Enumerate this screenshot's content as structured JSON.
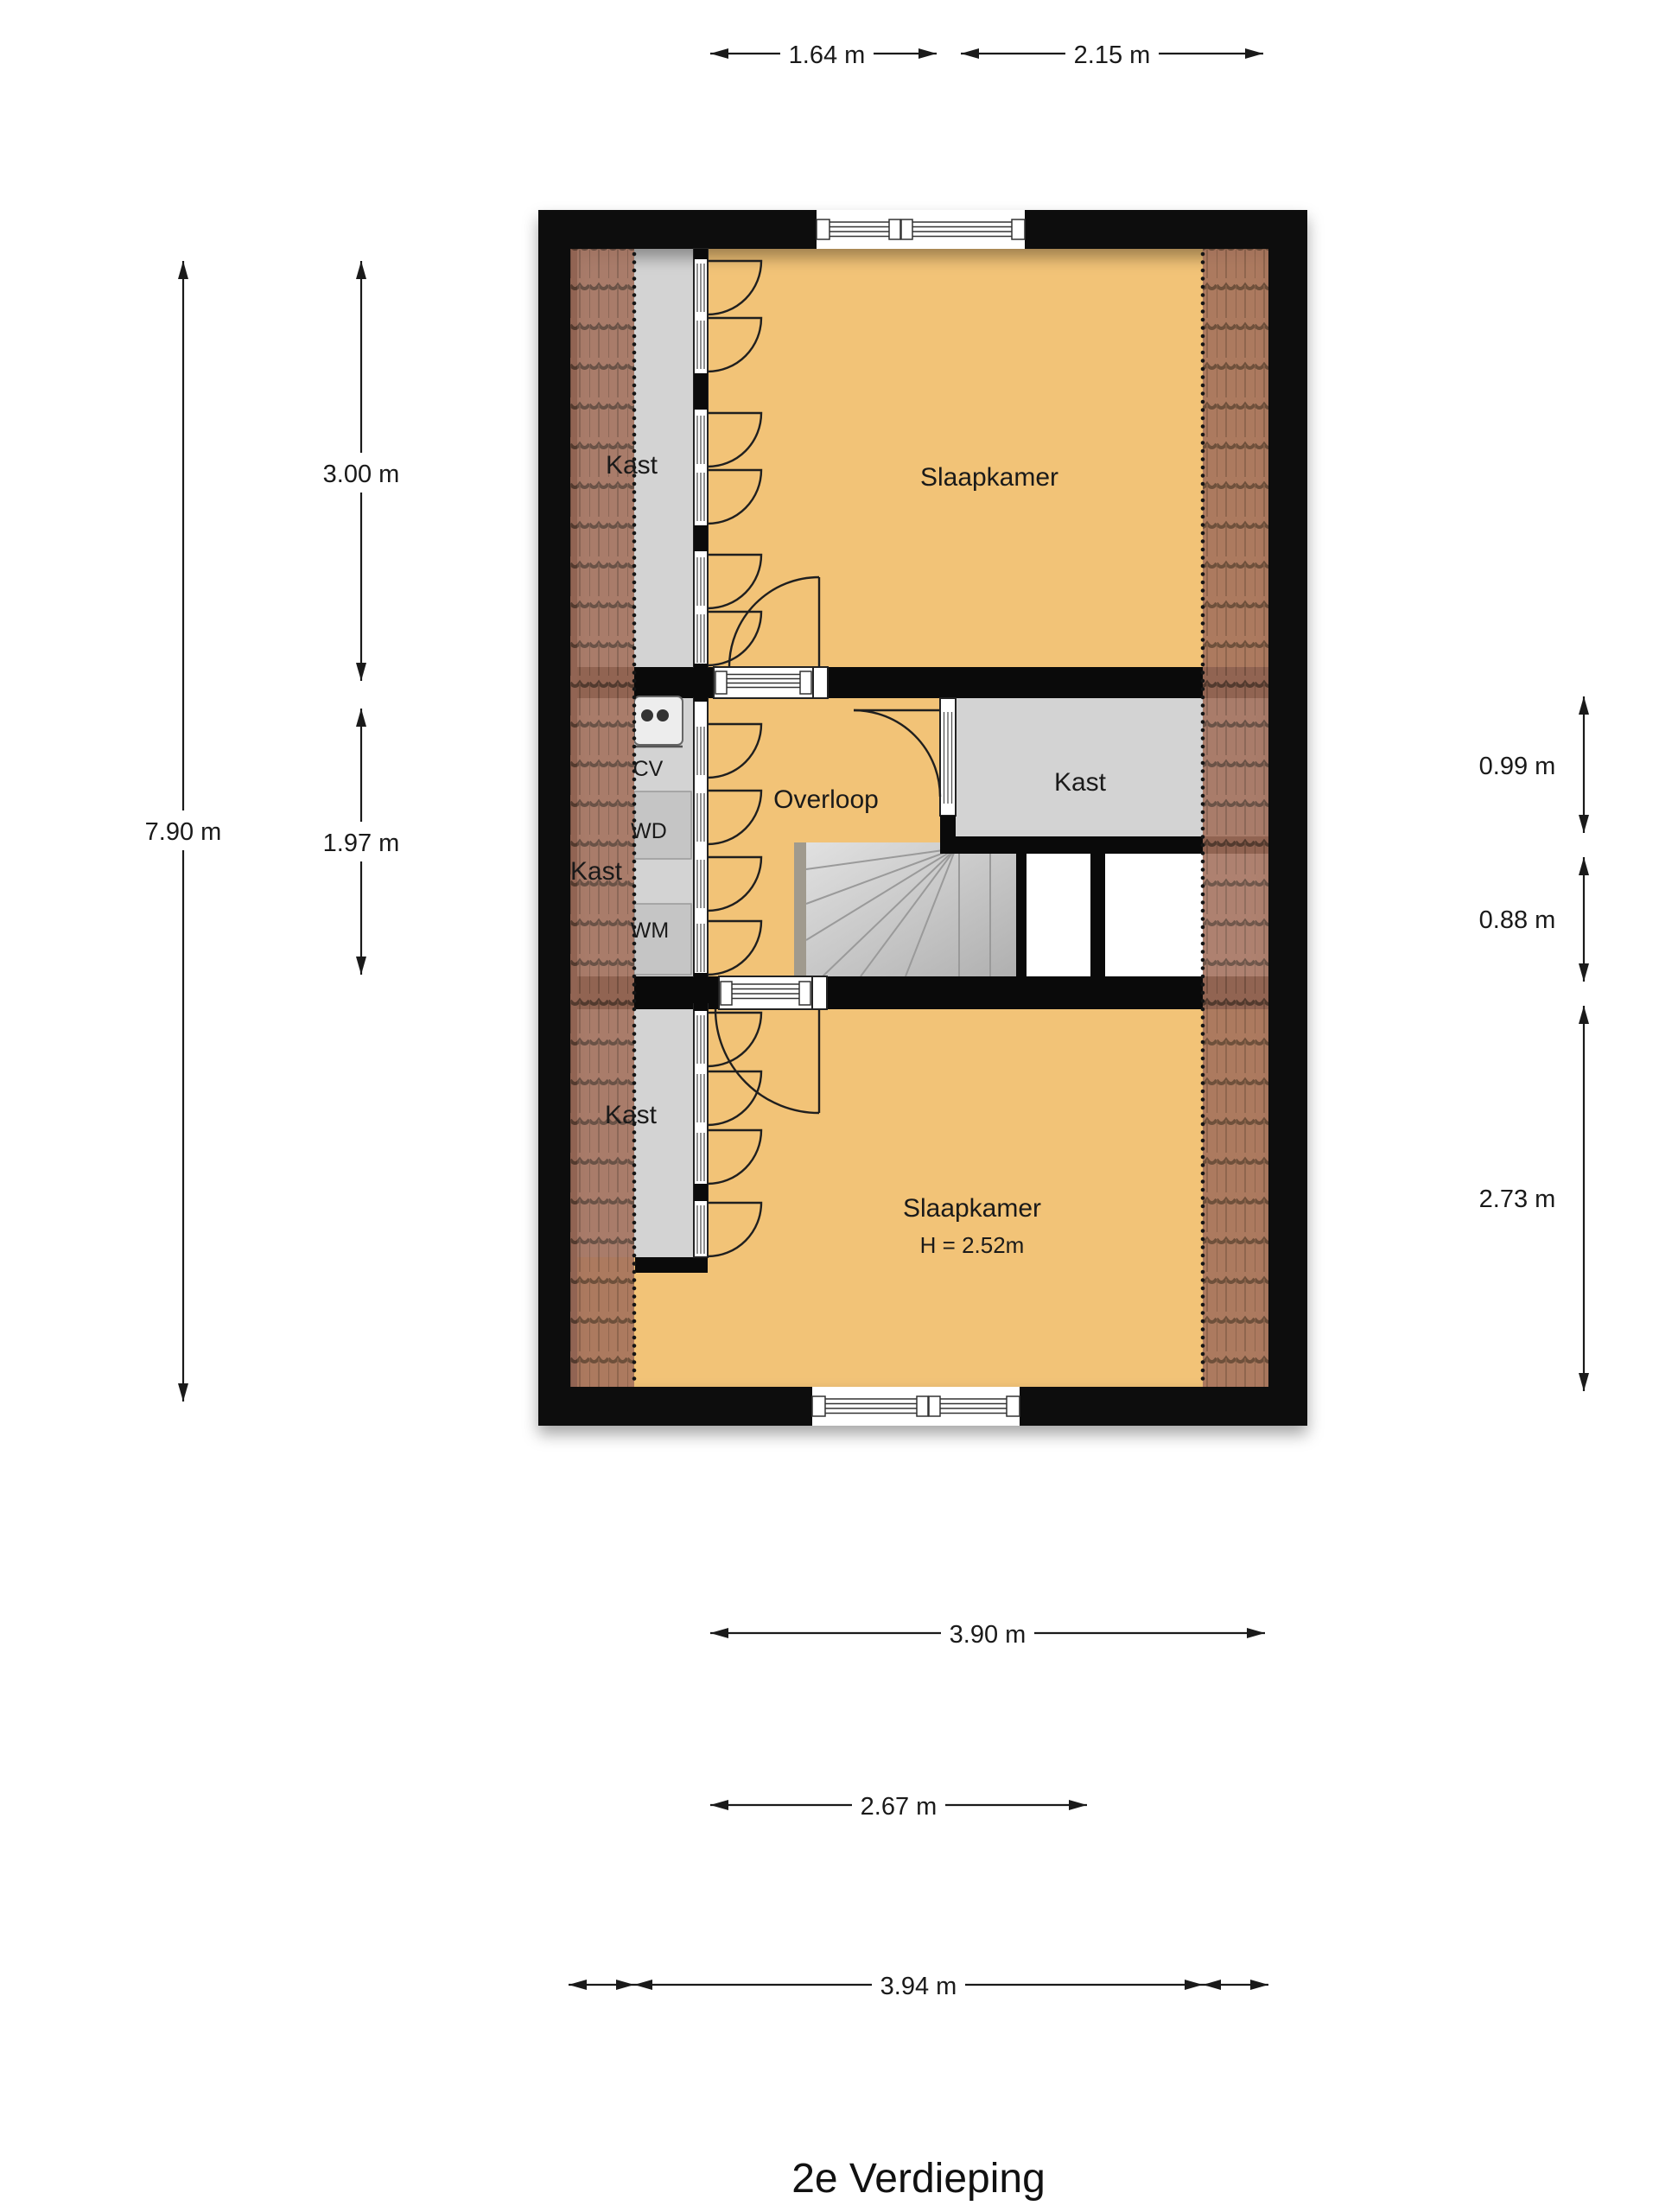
{
  "title": "2e Verdieping",
  "floor_plan": {
    "rooms": {
      "slaapkamer_top": "Slaapkamer",
      "slaapkamer_bottom": "Slaapkamer",
      "slaapkamer_bottom_height": "H = 2.52m",
      "overloop": "Overloop",
      "kast_top": "Kast",
      "kast_mid_left": "Kast",
      "kast_right": "Kast",
      "kast_bottom": "Kast",
      "cv": "CV",
      "wd": "WD",
      "wm": "WM"
    },
    "dimensions": {
      "top_left_width": "1.64 m",
      "top_right_width": "2.15 m",
      "left_total_height": "7.90 m",
      "left_top_height": "3.00 m",
      "left_middle_height": "1.97 m",
      "right_kast_height": "0.99 m",
      "right_void_height": "0.88 m",
      "right_bottom_height": "2.73 m",
      "bottom_room_width": "3.90 m",
      "bottom_middle_width": "2.67 m",
      "bottom_total_width": "3.94 m"
    }
  },
  "colors": {
    "floor_orange": "#f2c377",
    "floor_gray": "#d3d3d3",
    "appliance_gray": "#c5c5c5",
    "wall_black": "#0a0a0a",
    "roof_tile": "#a3705c",
    "roof_tile_line": "#5c4033",
    "stair_light": "#e2e2e2",
    "stair_dark": "#b0b0b0",
    "dimension_line": "#1a1a1a",
    "background": "#ffffff"
  }
}
